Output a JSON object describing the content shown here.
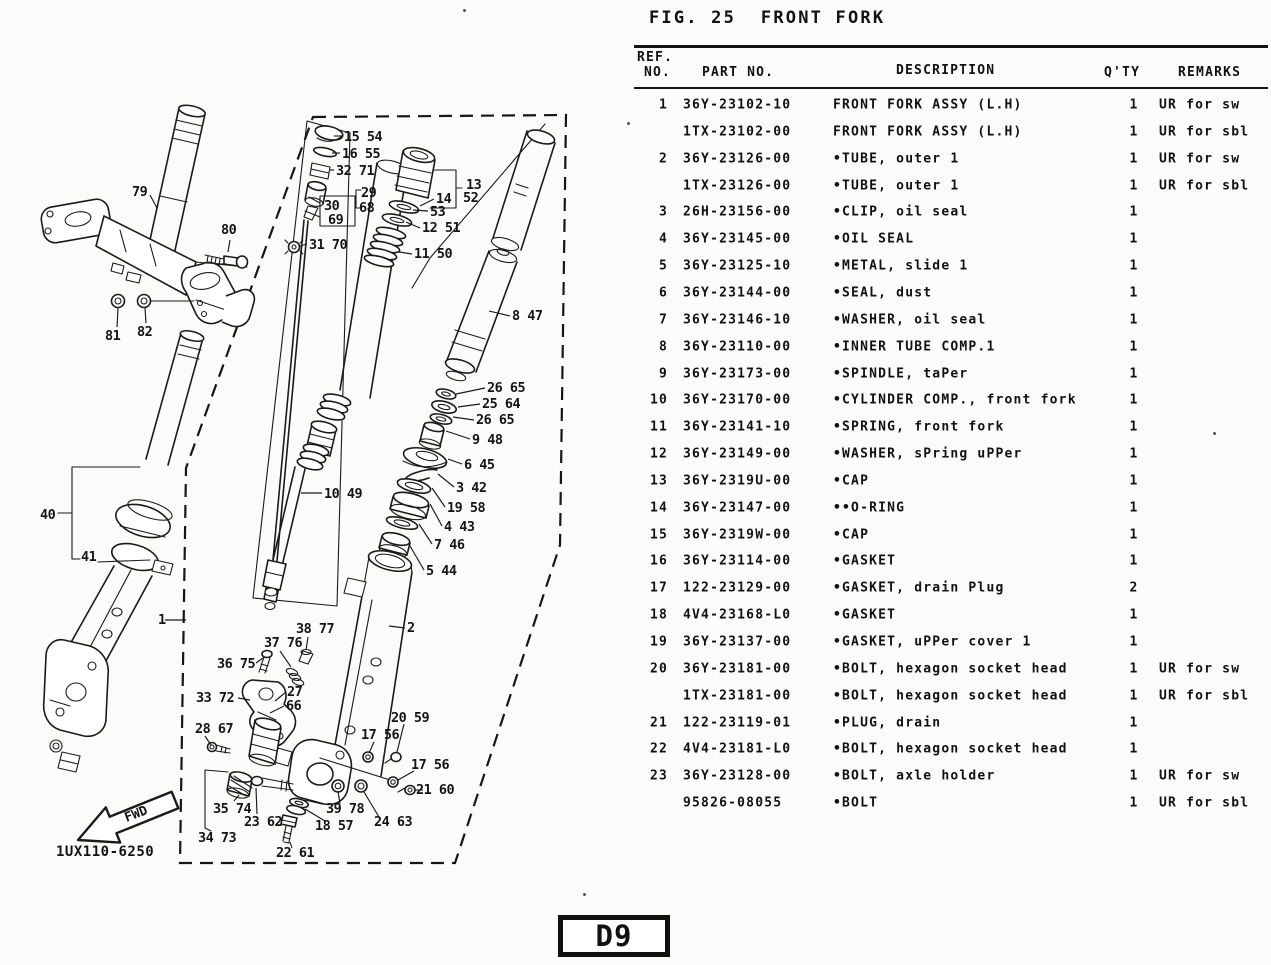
{
  "figure": {
    "title": "FIG. 25  FRONT FORK"
  },
  "table": {
    "headers": {
      "ref1": "REF.",
      "ref2": "NO.",
      "part": "PART NO.",
      "desc": "DESCRIPTION",
      "qty": "Q'TY",
      "remarks": "REMARKS"
    },
    "rows": [
      {
        "ref": "1",
        "part": "36Y-23102-10",
        "desc": "FRONT FORK ASSY (L.H)",
        "qty": "1",
        "remarks": "UR for sw"
      },
      {
        "ref": "",
        "part": "1TX-23102-00",
        "desc": "FRONT FORK ASSY (L.H)",
        "qty": "1",
        "remarks": "UR for sbl"
      },
      {
        "ref": "2",
        "part": "36Y-23126-00",
        "desc": "•TUBE, outer 1",
        "qty": "1",
        "remarks": "UR for sw"
      },
      {
        "ref": "",
        "part": "1TX-23126-00",
        "desc": "•TUBE, outer 1",
        "qty": "1",
        "remarks": "UR for sbl"
      },
      {
        "ref": "3",
        "part": "26H-23156-00",
        "desc": "•CLIP, oil seal",
        "qty": "1",
        "remarks": ""
      },
      {
        "ref": "4",
        "part": "36Y-23145-00",
        "desc": "•OIL SEAL",
        "qty": "1",
        "remarks": ""
      },
      {
        "ref": "5",
        "part": "36Y-23125-10",
        "desc": "•METAL, slide 1",
        "qty": "1",
        "remarks": ""
      },
      {
        "ref": "6",
        "part": "36Y-23144-00",
        "desc": "•SEAL, dust",
        "qty": "1",
        "remarks": ""
      },
      {
        "ref": "7",
        "part": "36Y-23146-10",
        "desc": "•WASHER, oil seal",
        "qty": "1",
        "remarks": ""
      },
      {
        "ref": "8",
        "part": "36Y-23110-00",
        "desc": "•INNER TUBE COMP.1",
        "qty": "1",
        "remarks": ""
      },
      {
        "ref": "9",
        "part": "36Y-23173-00",
        "desc": "•SPINDLE, taPer",
        "qty": "1",
        "remarks": ""
      },
      {
        "ref": "10",
        "part": "36Y-23170-00",
        "desc": "•CYLINDER COMP., front fork",
        "qty": "1",
        "remarks": ""
      },
      {
        "ref": "11",
        "part": "36Y-23141-10",
        "desc": "•SPRING, front fork",
        "qty": "1",
        "remarks": ""
      },
      {
        "ref": "12",
        "part": "36Y-23149-00",
        "desc": "•WASHER, sPring uPPer",
        "qty": "1",
        "remarks": ""
      },
      {
        "ref": "13",
        "part": "36Y-2319U-00",
        "desc": "•CAP",
        "qty": "1",
        "remarks": ""
      },
      {
        "ref": "14",
        "part": "36Y-23147-00",
        "desc": "••O-RING",
        "qty": "1",
        "remarks": ""
      },
      {
        "ref": "15",
        "part": "36Y-2319W-00",
        "desc": "•CAP",
        "qty": "1",
        "remarks": ""
      },
      {
        "ref": "16",
        "part": "36Y-23114-00",
        "desc": "•GASKET",
        "qty": "1",
        "remarks": ""
      },
      {
        "ref": "17",
        "part": "122-23129-00",
        "desc": "•GASKET, drain Plug",
        "qty": "2",
        "remarks": ""
      },
      {
        "ref": "18",
        "part": "4V4-23168-L0",
        "desc": "•GASKET",
        "qty": "1",
        "remarks": ""
      },
      {
        "ref": "19",
        "part": "36Y-23137-00",
        "desc": "•GASKET, uPPer cover 1",
        "qty": "1",
        "remarks": ""
      },
      {
        "ref": "20",
        "part": "36Y-23181-00",
        "desc": "•BOLT, hexagon socket head",
        "qty": "1",
        "remarks": "UR for sw"
      },
      {
        "ref": "",
        "part": "1TX-23181-00",
        "desc": "•BOLT, hexagon socket head",
        "qty": "1",
        "remarks": "UR for sbl"
      },
      {
        "ref": "21",
        "part": "122-23119-01",
        "desc": "•PLUG, drain",
        "qty": "1",
        "remarks": ""
      },
      {
        "ref": "22",
        "part": "4V4-23181-L0",
        "desc": "•BOLT, hexagon socket head",
        "qty": "1",
        "remarks": ""
      },
      {
        "ref": "23",
        "part": "36Y-23128-00",
        "desc": "•BOLT, axle holder",
        "qty": "1",
        "remarks": "UR for sw"
      },
      {
        "ref": "",
        "part": "95826-08055",
        "desc": "•BOLT",
        "qty": "1",
        "remarks": "UR for sbl"
      }
    ]
  },
  "diagram": {
    "code": "1UX110-6250",
    "fwd_label": "FWD",
    "labels": [
      {
        "t": "79",
        "x": 132,
        "y": 196,
        "l": [
          150,
          195,
          157,
          208
        ]
      },
      {
        "t": "80",
        "x": 221,
        "y": 234,
        "l": [
          230,
          240,
          228,
          252
        ]
      },
      {
        "t": "81",
        "x": 105,
        "y": 340,
        "l": [
          117,
          327,
          118,
          308
        ]
      },
      {
        "t": "82",
        "x": 137,
        "y": 336,
        "l": [
          146,
          323,
          145,
          308
        ]
      },
      {
        "t": "15 54",
        "x": 344,
        "y": 141,
        "l": [
          342,
          136,
          334,
          136
        ]
      },
      {
        "t": "16 55",
        "x": 342,
        "y": 158,
        "l": [
          340,
          153,
          332,
          153
        ]
      },
      {
        "t": "32 71",
        "x": 336,
        "y": 175,
        "l": [
          334,
          170,
          329,
          170
        ]
      },
      {
        "t": "29",
        "x": 361,
        "y": 197
      },
      {
        "t": "68",
        "x": 359,
        "y": 212
      },
      {
        "t": "30",
        "x": 324,
        "y": 210
      },
      {
        "t": "69",
        "x": 328,
        "y": 224
      },
      {
        "t": "31 70",
        "x": 309,
        "y": 249,
        "l": [
          307,
          244,
          300,
          246
        ]
      },
      {
        "t": "13",
        "x": 466,
        "y": 189
      },
      {
        "t": "52",
        "x": 463,
        "y": 202
      },
      {
        "t": "14",
        "x": 436,
        "y": 203,
        "l": [
          434,
          199,
          420,
          206
        ]
      },
      {
        "t": "53",
        "x": 430,
        "y": 216,
        "l": [
          428,
          211,
          413,
          210
        ]
      },
      {
        "t": "12 51",
        "x": 422,
        "y": 232,
        "l": [
          420,
          228,
          406,
          222
        ]
      },
      {
        "t": "11 50",
        "x": 414,
        "y": 258,
        "l": [
          412,
          254,
          399,
          252
        ]
      },
      {
        "t": "8 47",
        "x": 512,
        "y": 320,
        "l": [
          510,
          316,
          489,
          311
        ]
      },
      {
        "t": "26 65",
        "x": 487,
        "y": 392,
        "l": [
          485,
          388,
          456,
          394
        ]
      },
      {
        "t": "25 64",
        "x": 482,
        "y": 408,
        "l": [
          480,
          404,
          458,
          407
        ]
      },
      {
        "t": "26 65",
        "x": 476,
        "y": 424,
        "l": [
          474,
          420,
          453,
          417
        ]
      },
      {
        "t": "9 48",
        "x": 472,
        "y": 444,
        "l": [
          470,
          439,
          446,
          431
        ]
      },
      {
        "t": "6 45",
        "x": 464,
        "y": 469,
        "l": [
          462,
          464,
          448,
          459
        ]
      },
      {
        "t": "3 42",
        "x": 456,
        "y": 492,
        "l": [
          454,
          487,
          438,
          474
        ]
      },
      {
        "t": "19 58",
        "x": 447,
        "y": 512,
        "l": [
          445,
          507,
          432,
          488
        ]
      },
      {
        "t": "4 43",
        "x": 444,
        "y": 531,
        "l": [
          442,
          526,
          430,
          504
        ]
      },
      {
        "t": "7 46",
        "x": 434,
        "y": 549,
        "l": [
          432,
          544,
          419,
          524
        ]
      },
      {
        "t": "5 44",
        "x": 426,
        "y": 575,
        "l": [
          424,
          570,
          410,
          546
        ]
      },
      {
        "t": "10 49",
        "x": 324,
        "y": 498,
        "l": [
          322,
          493,
          301,
          493
        ]
      },
      {
        "t": "40",
        "x": 40,
        "y": 519
      },
      {
        "t": "41",
        "x": 81,
        "y": 561
      },
      {
        "t": "1",
        "x": 158,
        "y": 624,
        "l": [
          165,
          620,
          186,
          620
        ]
      },
      {
        "t": "2",
        "x": 407,
        "y": 632,
        "l": [
          405,
          628,
          389,
          626
        ]
      },
      {
        "t": "38 77",
        "x": 296,
        "y": 633,
        "l": [
          308,
          637,
          306,
          650
        ]
      },
      {
        "t": "37 76",
        "x": 264,
        "y": 647,
        "l": [
          280,
          651,
          291,
          667
        ]
      },
      {
        "t": "36 75",
        "x": 217,
        "y": 668,
        "l": [
          256,
          663,
          263,
          658
        ]
      },
      {
        "t": "33 72",
        "x": 196,
        "y": 702,
        "l": [
          238,
          698,
          250,
          700
        ]
      },
      {
        "t": "27",
        "x": 287,
        "y": 696,
        "l": [
          286,
          692,
          275,
          701
        ]
      },
      {
        "t": "66",
        "x": 286,
        "y": 710,
        "l": [
          284,
          706,
          270,
          713
        ]
      },
      {
        "t": "28 67",
        "x": 195,
        "y": 733,
        "l": [
          205,
          736,
          211,
          745
        ]
      },
      {
        "t": "20 59",
        "x": 391,
        "y": 722,
        "l": [
          404,
          724,
          397,
          752
        ]
      },
      {
        "t": "17 56",
        "x": 361,
        "y": 739,
        "l": [
          374,
          742,
          369,
          753
        ]
      },
      {
        "t": "17 56",
        "x": 411,
        "y": 769,
        "l": [
          414,
          771,
          398,
          780
        ]
      },
      {
        "t": "21 60",
        "x": 416,
        "y": 794,
        "l": [
          423,
          790,
          415,
          790
        ]
      },
      {
        "t": "39 78",
        "x": 326,
        "y": 813,
        "l": [
          340,
          804,
          338,
          791
        ]
      },
      {
        "t": "24 63",
        "x": 374,
        "y": 826,
        "l": [
          379,
          817,
          364,
          792
        ]
      },
      {
        "t": "18 57",
        "x": 315,
        "y": 830,
        "l": [
          325,
          821,
          305,
          809
        ]
      },
      {
        "t": "23 62",
        "x": 244,
        "y": 826,
        "l": [
          257,
          814,
          256,
          788
        ]
      },
      {
        "t": "22 61",
        "x": 276,
        "y": 857,
        "l": [
          292,
          848,
          290,
          842
        ]
      },
      {
        "t": "35 74",
        "x": 213,
        "y": 813,
        "l": [
          234,
          801,
          239,
          795
        ]
      },
      {
        "t": "34 73",
        "x": 198,
        "y": 842
      }
    ]
  },
  "footer": {
    "page_code": "D9"
  }
}
